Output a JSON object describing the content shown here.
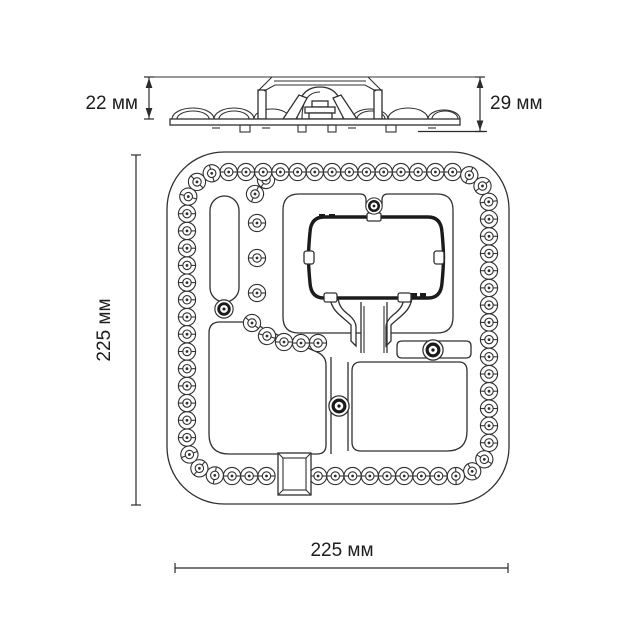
{
  "colors": {
    "line": "#303030",
    "bracket_line": "#1b1b1b",
    "background": "#ffffff"
  },
  "side_view": {
    "height_label": "22 мм",
    "total_height_label": "29 мм"
  },
  "front_view": {
    "height_label": "225 мм",
    "width_label": "225 мм"
  }
}
